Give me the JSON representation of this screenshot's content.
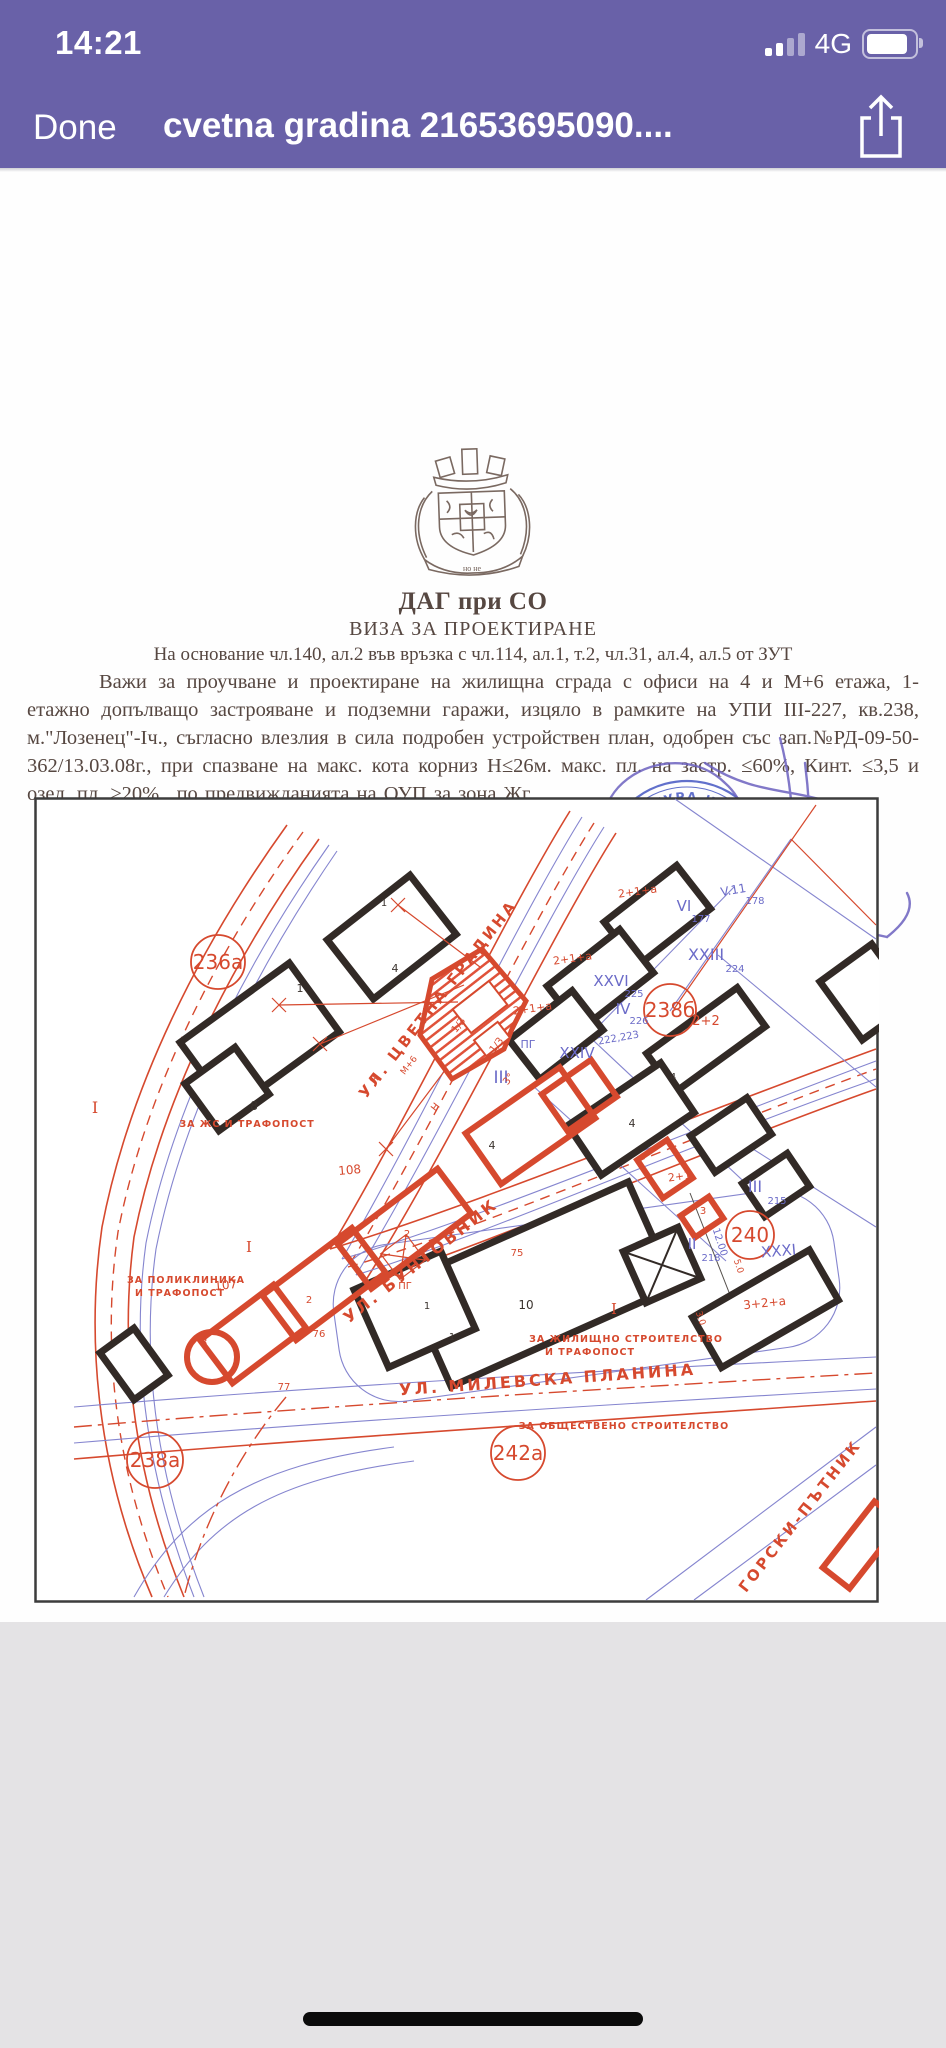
{
  "status_bar": {
    "time": "14:21",
    "network": "4G"
  },
  "nav_bar": {
    "done_label": "Done",
    "title": "cvetna gradina 21653695090...."
  },
  "document": {
    "org": "ДАГ при СО",
    "doc_type": "ВИЗА ЗА ПРОЕКТИРАНЕ",
    "legal_basis": "На основание чл.140, ал.2 във връзка с чл.114, ал.1, т.2, чл.31, ал.4, ал.5 от ЗУТ",
    "body": "Важи за проучване и проектиране на жилищна сграда с офиси на  4 и М+6 етажа, 1-етажно допълващо застрояване и подземни гаражи, изцяло в рамките на УПИ III-227, кв.238, м.\"Лозенец\"-Iч., съгласно влезлия в сила подробен устройствен план, одобрен със зап.№РД-09-50-362/13.03.08г., при спазване на макс. кота корниз Н≤26м. макс. пл. на застр. ≤60%, Кинт. ≤3,5 и озел. пл. ≥20%., по предвижданията на ОУП  за зона Жг.",
    "emblem_motto": "но не",
    "signature": {
      "title": "ГЛАВЕН АРХИТЕКТ НА СТОЛИЧНА ОБЩИНА",
      "name": "ПЕТЪР ДИКОВ",
      "handwritten_date": "11. 11. 09.",
      "stamp_ring": "АРХИТЕКТУРА И ГРАДОУСТРОЙСТВО",
      "stamp_city": "• София •"
    }
  },
  "map": {
    "accent_red": "#d6492e",
    "accent_blue": "#6b6bc8",
    "circles": [
      {
        "t": "236а",
        "x": 184,
        "y": 165,
        "rr": 27
      },
      {
        "t": "238б",
        "x": 636,
        "y": 213,
        "rr": 26
      },
      {
        "t": "240",
        "x": 716,
        "y": 438,
        "rr": 24
      },
      {
        "t": "242а",
        "x": 484,
        "y": 656,
        "rr": 27
      },
      {
        "t": "238а",
        "x": 121,
        "y": 663,
        "rr": 28
      }
    ],
    "labels": [
      {
        "t": "УЛ.  ЦВЕТНА  ГРАДИНА",
        "x": 408,
        "y": 205,
        "r": -52,
        "s": 15,
        "c": "st"
      },
      {
        "t": "УЛ.  БУНТОВНИК",
        "x": 390,
        "y": 468,
        "r": -38,
        "s": 16,
        "c": "st"
      },
      {
        "t": "УЛ.  МИЛЕВСКА  ПЛАНИНА",
        "x": 514,
        "y": 588,
        "r": -4,
        "s": 16,
        "c": "st"
      },
      {
        "t": "ГОРСКИ-ПЪТНИК",
        "x": 770,
        "y": 722,
        "r": -52,
        "s": 15,
        "c": "st"
      },
      {
        "t": "V.11",
        "x": 700,
        "y": 97,
        "r": -10,
        "s": 12,
        "c": "bu"
      },
      {
        "t": "178",
        "x": 721,
        "y": 107,
        "r": 0,
        "s": 10,
        "c": "bu"
      },
      {
        "t": "VI",
        "x": 650,
        "y": 114,
        "r": 0,
        "s": 15,
        "c": "bu"
      },
      {
        "t": "177",
        "x": 667,
        "y": 125,
        "r": 0,
        "s": 10,
        "c": "bu"
      },
      {
        "t": "XXIII",
        "x": 672,
        "y": 163,
        "r": 0,
        "s": 16,
        "c": "bu"
      },
      {
        "t": "224",
        "x": 701,
        "y": 175,
        "r": 0,
        "s": 10,
        "c": "bu"
      },
      {
        "t": "XXVI",
        "x": 577,
        "y": 189,
        "r": 0,
        "s": 15,
        "c": "bu"
      },
      {
        "t": "225",
        "x": 600,
        "y": 200,
        "r": 0,
        "s": 10,
        "c": "bu"
      },
      {
        "t": "IV",
        "x": 589,
        "y": 217,
        "r": 0,
        "s": 15,
        "c": "bu"
      },
      {
        "t": "226",
        "x": 605,
        "y": 227,
        "r": 0,
        "s": 10,
        "c": "bu"
      },
      {
        "t": "222,223",
        "x": 585,
        "y": 244,
        "r": -10,
        "s": 10,
        "c": "bu"
      },
      {
        "t": "XXIV",
        "x": 543,
        "y": 261,
        "r": 0,
        "s": 15,
        "c": "bu"
      },
      {
        "t": "III",
        "x": 467,
        "y": 286,
        "r": 0,
        "s": 17,
        "c": "bu"
      },
      {
        "t": "ПГ",
        "x": 494,
        "y": 251,
        "r": 0,
        "s": 11,
        "c": "bu"
      },
      {
        "t": "III",
        "x": 721,
        "y": 395,
        "r": 0,
        "s": 16,
        "c": "bu"
      },
      {
        "t": "215",
        "x": 743,
        "y": 407,
        "r": 0,
        "s": 10,
        "c": "bu"
      },
      {
        "t": "II",
        "x": 658,
        "y": 452,
        "r": 0,
        "s": 15,
        "c": "bu"
      },
      {
        "t": "218",
        "x": 677,
        "y": 464,
        "r": 0,
        "s": 10,
        "c": "bu"
      },
      {
        "t": "XXXI",
        "x": 745,
        "y": 459,
        "r": -5,
        "s": 15,
        "c": "bu"
      },
      {
        "t": "12.00",
        "x": 683,
        "y": 446,
        "r": 72,
        "s": 10,
        "c": "bu"
      },
      {
        "t": "2+1+а",
        "x": 604,
        "y": 98,
        "r": -8,
        "s": 11,
        "c": "rd"
      },
      {
        "t": "2+1+а",
        "x": 539,
        "y": 165,
        "r": -8,
        "s": 11,
        "c": "rd"
      },
      {
        "t": "2+1+а",
        "x": 499,
        "y": 215,
        "r": -8,
        "s": 11,
        "c": "rd"
      },
      {
        "t": "2+2",
        "x": 672,
        "y": 228,
        "r": 0,
        "s": 13,
        "c": "rd"
      },
      {
        "t": "2+1",
        "x": 646,
        "y": 383,
        "r": -8,
        "s": 11,
        "c": "rd"
      },
      {
        "t": "3",
        "x": 669,
        "y": 417,
        "r": 0,
        "s": 10,
        "c": "rd"
      },
      {
        "t": "3+2+а",
        "x": 731,
        "y": 510,
        "r": -6,
        "s": 12,
        "c": "rd"
      },
      {
        "t": "5.0",
        "x": 702,
        "y": 470,
        "r": 72,
        "s": 9,
        "c": "rd"
      },
      {
        "t": "3.0",
        "x": 664,
        "y": 522,
        "r": 72,
        "s": 9,
        "c": "rd"
      },
      {
        "t": "108",
        "x": 316,
        "y": 377,
        "r": -5,
        "s": 12,
        "c": "rd"
      },
      {
        "t": "107",
        "x": 192,
        "y": 492,
        "r": -5,
        "s": 12,
        "c": "rd"
      },
      {
        "t": "76",
        "x": 285,
        "y": 540,
        "r": 0,
        "s": 10,
        "c": "rd"
      },
      {
        "t": "77",
        "x": 250,
        "y": 593,
        "r": 0,
        "s": 10,
        "c": "rd"
      },
      {
        "t": "75",
        "x": 483,
        "y": 459,
        "r": 0,
        "s": 10,
        "c": "rd"
      },
      {
        "t": "ПГ",
        "x": 371,
        "y": 492,
        "r": 0,
        "s": 10,
        "c": "rd"
      },
      {
        "t": "3",
        "x": 170,
        "y": 549,
        "r": 0,
        "s": 11,
        "c": "rd"
      },
      {
        "t": "2",
        "x": 275,
        "y": 506,
        "r": 0,
        "s": 10,
        "c": "rd"
      },
      {
        "t": "2",
        "x": 373,
        "y": 440,
        "r": 0,
        "s": 10,
        "c": "rd"
      },
      {
        "t": "М+6",
        "x": 377,
        "y": 270,
        "r": -52,
        "s": 9,
        "c": "rd"
      },
      {
        "t": "Н",
        "x": 343,
        "y": 285,
        "r": -52,
        "s": 10,
        "c": "rd"
      },
      {
        "t": "1/3",
        "x": 427,
        "y": 230,
        "r": -52,
        "s": 10,
        "c": "rd"
      },
      {
        "t": "1/3",
        "x": 465,
        "y": 250,
        "r": -52,
        "s": 10,
        "c": "rd"
      },
      {
        "t": "3°",
        "x": 451,
        "y": 154,
        "r": -52,
        "s": 10,
        "c": "rd"
      },
      {
        "t": "3°",
        "x": 477,
        "y": 284,
        "r": -52,
        "s": 10,
        "c": "rd"
      },
      {
        "t": "Н",
        "x": 404,
        "y": 312,
        "r": -52,
        "s": 10,
        "c": "rd"
      },
      {
        "t": "I",
        "x": 61,
        "y": 316,
        "r": 0,
        "s": 16,
        "c": "rdc"
      },
      {
        "t": "I",
        "x": 215,
        "y": 455,
        "r": 0,
        "s": 15,
        "c": "rdc"
      },
      {
        "t": "I",
        "x": 580,
        "y": 517,
        "r": 0,
        "s": 15,
        "c": "rdc"
      },
      {
        "t": "ЗА ЖС И ТРАФОПОСТ",
        "x": 213,
        "y": 330,
        "r": 0,
        "s": 9.5,
        "c": "zn"
      },
      {
        "t": "ЗА ПОЛИКЛИНИКА",
        "x": 152,
        "y": 486,
        "r": 0,
        "s": 9.5,
        "c": "zn"
      },
      {
        "t": "И ТРАФОПОСТ",
        "x": 146,
        "y": 499,
        "r": 0,
        "s": 9.5,
        "c": "zn"
      },
      {
        "t": "ЗА ЖИЛИЩНО СТРОИТЕЛСТВО",
        "x": 592,
        "y": 545,
        "r": 0,
        "s": 9.5,
        "c": "zn"
      },
      {
        "t": "И ТРАФОПОСТ",
        "x": 556,
        "y": 558,
        "r": 0,
        "s": 9.5,
        "c": "zn"
      },
      {
        "t": "ЗА ОБЩЕСТВЕНО СТРОИТЕЛСТВО",
        "x": 590,
        "y": 632,
        "r": 0,
        "s": 9.5,
        "c": "zn"
      },
      {
        "t": "1",
        "x": 266,
        "y": 195,
        "r": 0,
        "s": 11,
        "c": "bk"
      },
      {
        "t": "8",
        "x": 220,
        "y": 313,
        "r": 0,
        "s": 12,
        "c": "bk"
      },
      {
        "t": "1",
        "x": 350,
        "y": 109,
        "r": 0,
        "s": 10,
        "c": "bk"
      },
      {
        "t": "4",
        "x": 361,
        "y": 175,
        "r": 0,
        "s": 11,
        "c": "bk"
      },
      {
        "t": "10",
        "x": 492,
        "y": 512,
        "r": 0,
        "s": 12,
        "c": "bk"
      },
      {
        "t": "1",
        "x": 393,
        "y": 512,
        "r": 0,
        "s": 10,
        "c": "bk"
      },
      {
        "t": "1",
        "x": 418,
        "y": 543,
        "r": 0,
        "s": 10,
        "c": "bk"
      },
      {
        "t": "4",
        "x": 598,
        "y": 330,
        "r": 0,
        "s": 11,
        "c": "bk"
      },
      {
        "t": "4",
        "x": 458,
        "y": 352,
        "r": 0,
        "s": 11,
        "c": "bk"
      },
      {
        "t": "4",
        "x": 639,
        "y": 283,
        "r": 0,
        "s": 10,
        "c": "bk"
      }
    ]
  }
}
